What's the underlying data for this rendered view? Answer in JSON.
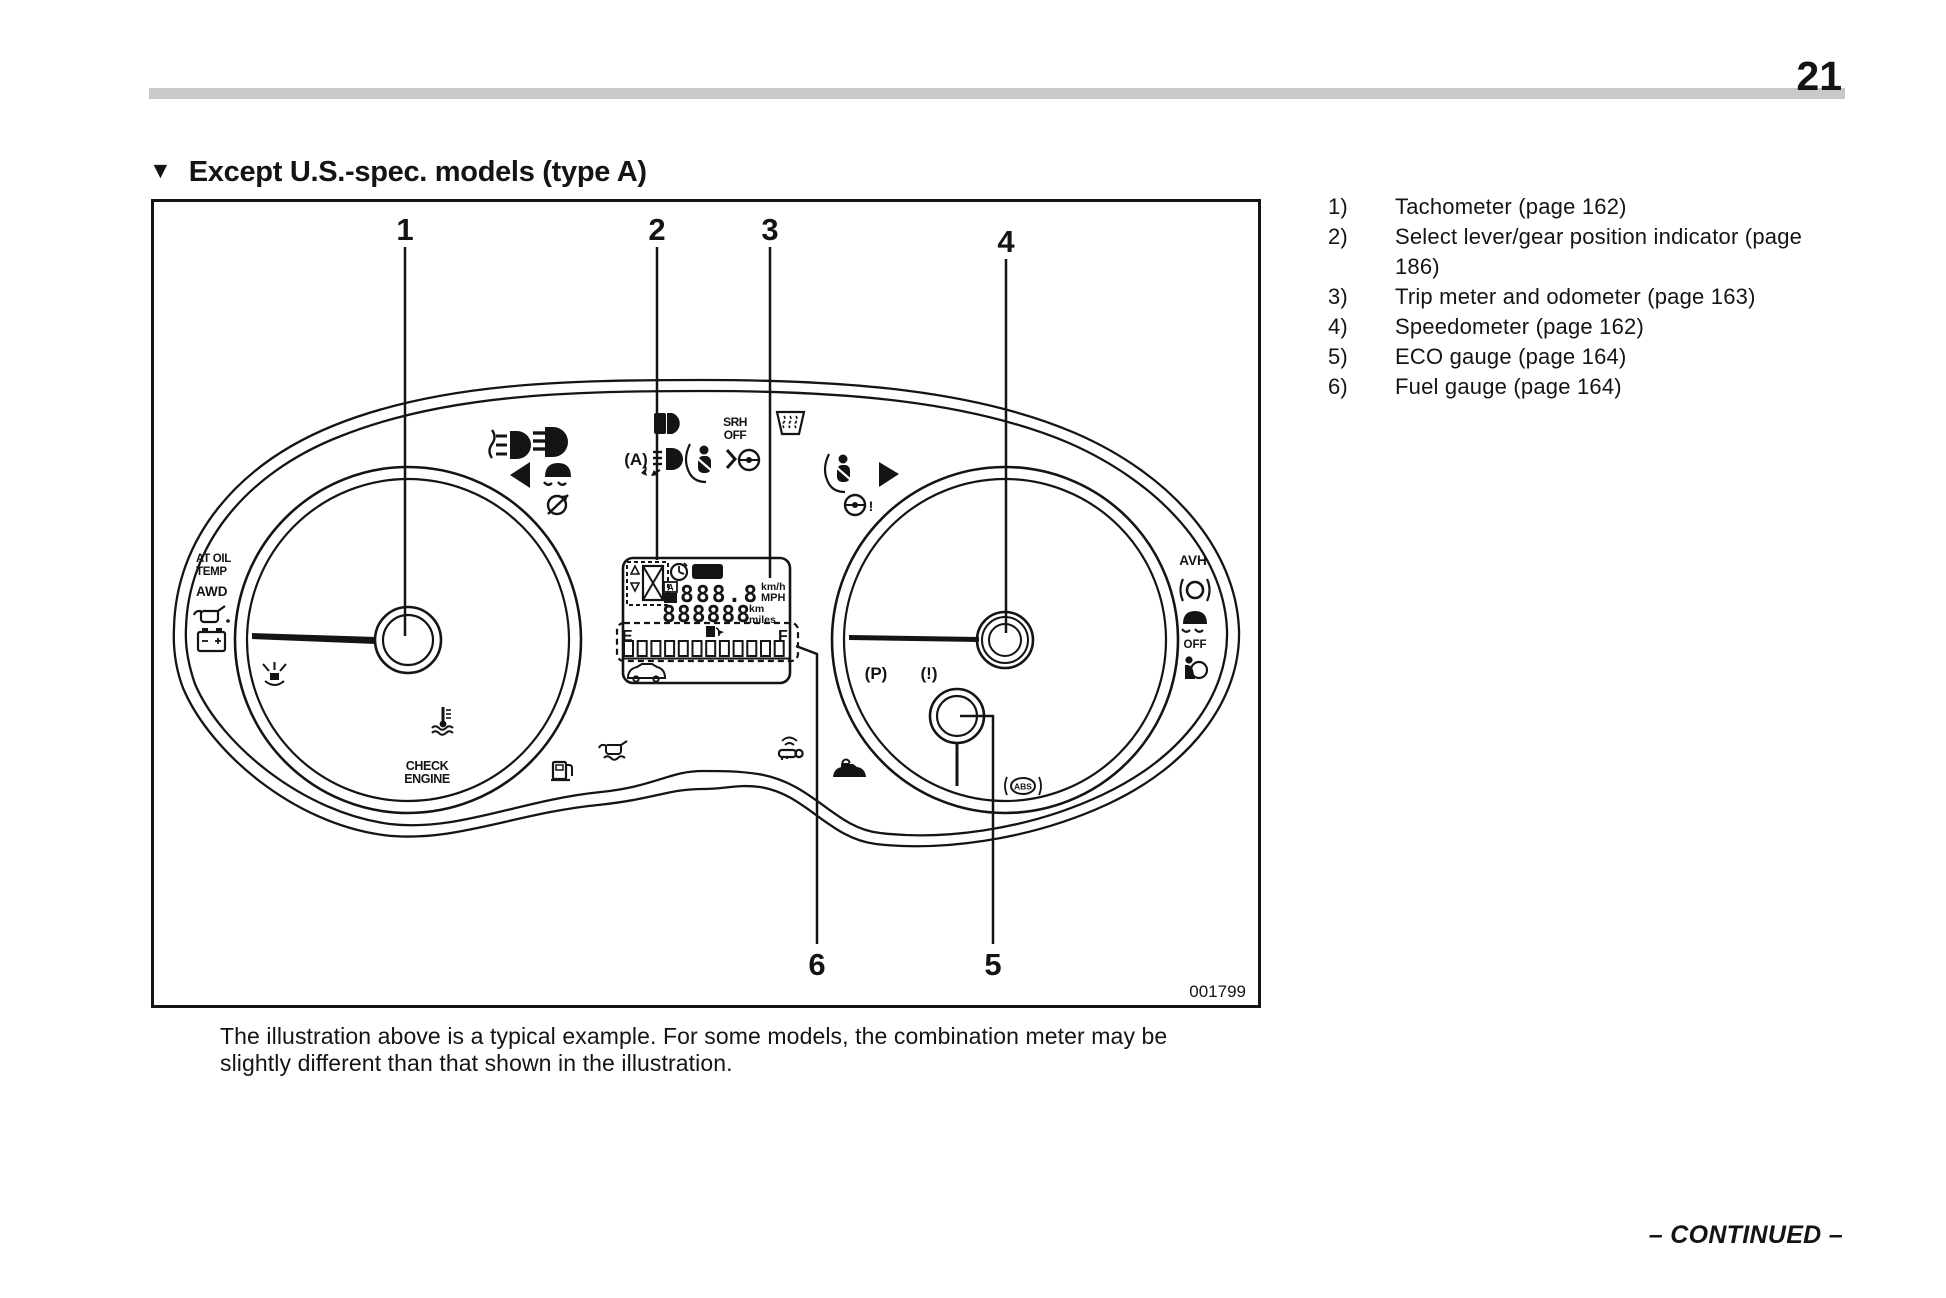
{
  "page": {
    "number": "21",
    "continued": "– CONTINUED –"
  },
  "heading": {
    "marker": "▼",
    "title": "Except U.S.-spec. models (type A)"
  },
  "figure": {
    "code": "001799",
    "callouts": {
      "c1": "1",
      "c2": "2",
      "c3": "3",
      "c4": "4",
      "c5": "5",
      "c6": "6"
    },
    "caption": {
      "line1": "The illustration above is a typical example. For some models, the combination meter may be",
      "line2": "slightly different than that shown in the illustration."
    },
    "cluster": {
      "at_oil": "AT OIL",
      "temp": "TEMP",
      "awd": "AWD",
      "check": "CHECK",
      "engine": "ENGINE",
      "srh": "SRH",
      "srh_off": "OFF",
      "avh": "AVH",
      "vdc_off": "OFF",
      "parking_brake": "(P)",
      "brake_warn": "(!)",
      "abs": "ABS",
      "auto_ss": "(A)",
      "steer_warn": "!",
      "lcd": {
        "set": "SET",
        "trip_a": "A",
        "trip_b": "B",
        "trip_value": "888.8",
        "unit_kmh": "km/h",
        "unit_mph": "MPH",
        "odo_value": "888888",
        "unit_km": "km",
        "unit_miles": "miles",
        "fuel_e": "E",
        "fuel_f": "F"
      }
    }
  },
  "legend": {
    "items": [
      {
        "num": "1)",
        "line1": "Tachometer (page 162)"
      },
      {
        "num": "2)",
        "line1": "Select lever/gear position indicator (page",
        "line2": "186)"
      },
      {
        "num": "3)",
        "line1": "Trip meter and odometer (page 163)"
      },
      {
        "num": "4)",
        "line1": "Speedometer (page 162)"
      },
      {
        "num": "5)",
        "line1": "ECO gauge (page 164)"
      },
      {
        "num": "6)",
        "line1": "Fuel gauge (page 164)"
      }
    ]
  }
}
